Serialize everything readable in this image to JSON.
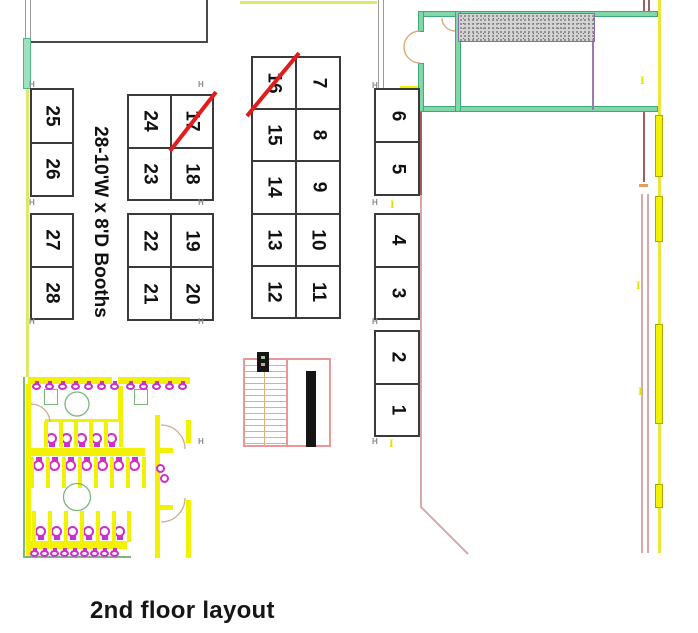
{
  "title": "2nd floor layout",
  "legend": {
    "booth_note": "28-10'W x 8'D Booths"
  },
  "booth_groups": [
    {
      "id": "left-pair-top",
      "cols": 1,
      "cells": [
        "25",
        "26"
      ]
    },
    {
      "id": "left-pair-bottom",
      "cols": 1,
      "cells": [
        "27",
        "28"
      ]
    },
    {
      "id": "left-grid-top",
      "cols": 2,
      "cells": [
        "24",
        "17",
        "23",
        "18"
      ]
    },
    {
      "id": "left-grid-bottom",
      "cols": 2,
      "cells": [
        "22",
        "19",
        "21",
        "20"
      ]
    },
    {
      "id": "center-grid",
      "cols": 2,
      "cells": [
        "16",
        "7",
        "15",
        "8",
        "14",
        "9",
        "13",
        "10",
        "12",
        "11"
      ]
    },
    {
      "id": "right-pair-1",
      "cols": 1,
      "cells": [
        "6",
        "5"
      ]
    },
    {
      "id": "right-pair-2",
      "cols": 1,
      "cells": [
        "4",
        "3"
      ]
    },
    {
      "id": "right-pair-3",
      "cols": 1,
      "cells": [
        "2",
        "1"
      ]
    }
  ],
  "crossed_booths": [
    "17",
    "16"
  ],
  "markers": {
    "corner_label": "H",
    "beam_label": "I"
  },
  "colors": {
    "booth_border": "#3a3a3a",
    "cross_red": "#e41b1b",
    "wall_yellow": "#f2f200",
    "wall_green": "#82d6a8",
    "fixture_magenta": "#cc2fcc",
    "stairs_pink": "#e89898",
    "hatch_gray": "#d4d4d4",
    "line_pink": "#d9a8a8",
    "line_maroon": "#9a6060",
    "line_purple": "#9a7ab0"
  }
}
